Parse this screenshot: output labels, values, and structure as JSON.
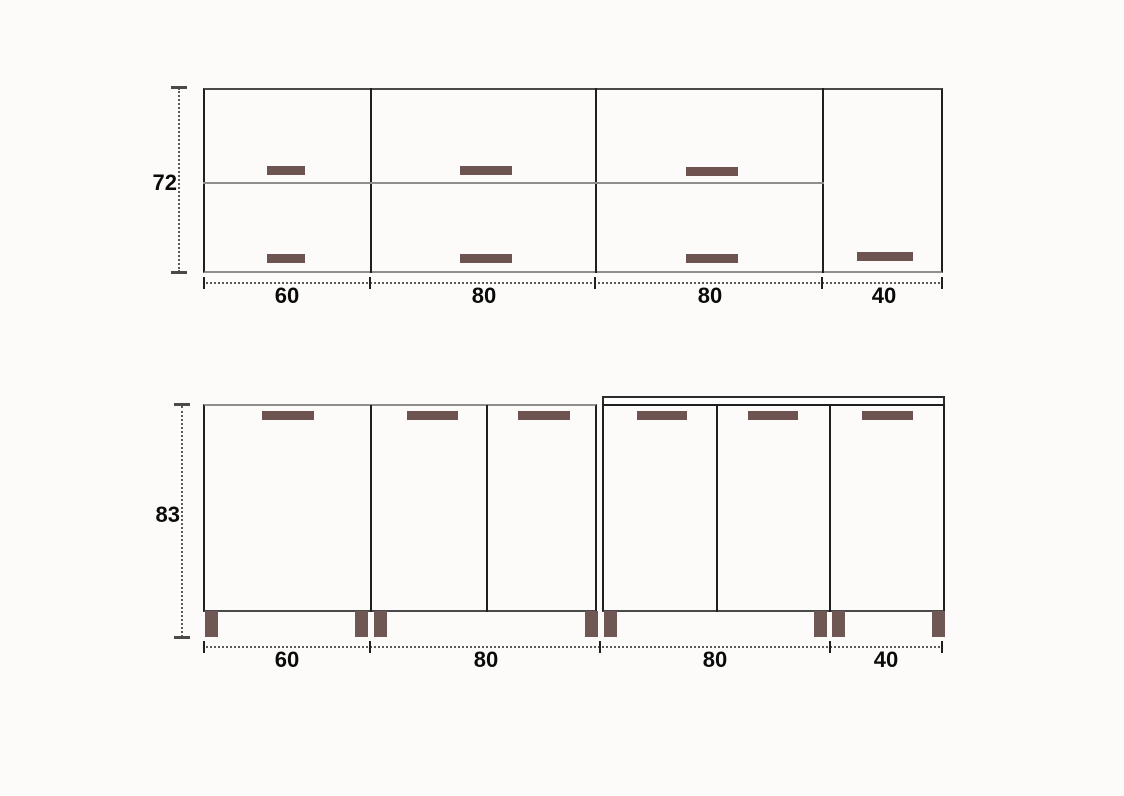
{
  "drawing": {
    "type": "kitchen cabinet elevation, upper and lower rows",
    "upper_row": {
      "height_label": "72",
      "width_labels": [
        "60",
        "80",
        "80",
        "40"
      ],
      "cabinet_count": 4
    },
    "lower_row": {
      "height_label": "83",
      "width_labels": [
        "60",
        "80",
        "80",
        "40"
      ],
      "cabinet_count": 4
    }
  },
  "colors": {
    "handle": "#6d5450",
    "foot": "#6f5853",
    "line-dark": "#1f1f1f",
    "line-gray": "#8f8f8f",
    "line-outer": "#4a4a4a",
    "dim-line": "#5a5a5a",
    "text": "#0a0a0a",
    "background": "#fcfbf9"
  }
}
